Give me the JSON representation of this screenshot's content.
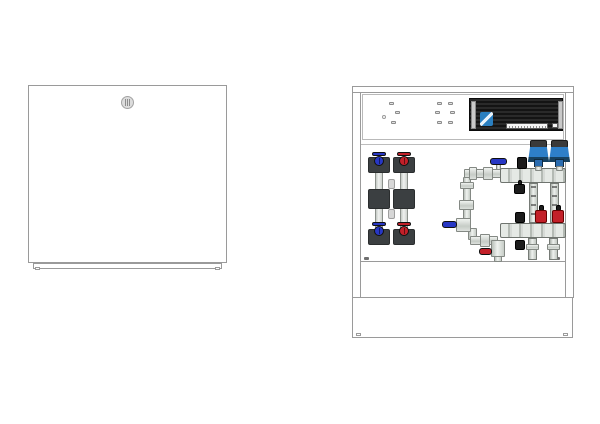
{
  "page": {
    "background": "#ffffff"
  },
  "colors": {
    "page_bg": "#ffffff",
    "outline": "#9a9a9a",
    "insulation": "#3b3f41",
    "pump_blue": "#2e7fc8",
    "handle_blue": "#2737c4",
    "handle_red": "#c32029",
    "black_part": "#1c1c1c",
    "controller_logo": "#2a7fc0",
    "label_strip": "#f4f4f4"
  },
  "views": {
    "closed": {
      "name": "manifold cabinet with door closed"
    },
    "open": {
      "name": "manifold cabinet opened showing hydronic module"
    }
  },
  "components": {
    "door": "cabinet front door",
    "lock": "coin-slot door lock",
    "plinth": "cabinet plinth",
    "frame": "cabinet frame rail",
    "top_panel": "electrical mounting panel",
    "screw": "mounting hole",
    "controller": "wiring center controller module",
    "controller_logo": "controller brand logo",
    "controller_label": "controller type label",
    "valve_assembly": "insulated heat-meter valve set",
    "blue_knob": "return shut-off valve knob",
    "red_knob": "supply shut-off valve knob",
    "supply_pipe": "supply connection pipe",
    "blue_lever": "blue ball valve lever",
    "red_lever": "red drain valve lever",
    "top_rail": "supply manifold rail",
    "bottom_rail": "return manifold rail",
    "pump": "circulation pump head",
    "flow_tube": "flow meter sight tube",
    "red_cap": "topmeter valve cap",
    "black_cap": "manifold end cap / air vent",
    "loop_pipe": "underfloor loop connection pipe",
    "skirt": "cabinet base extension"
  }
}
